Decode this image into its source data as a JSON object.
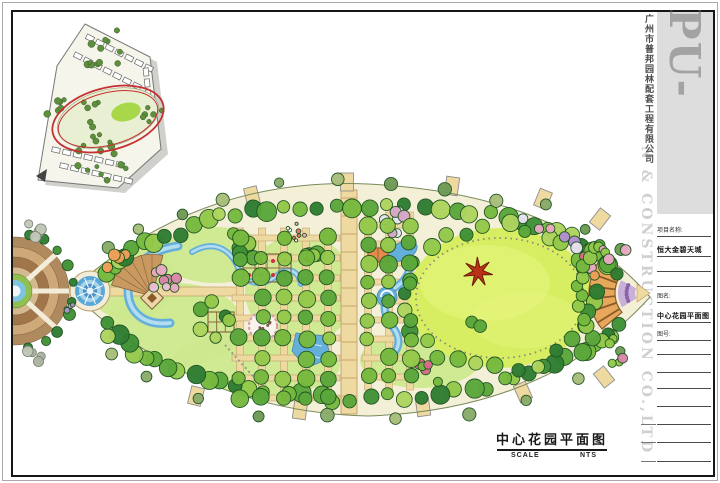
{
  "caption": {
    "title": "中心花园平面图",
    "scale_label": "SCALE",
    "scale_value": "NTS"
  },
  "watermark": {
    "brand": "PU-BANG",
    "company_cn": "广州市普邦园林配套工程有限公司",
    "company_en": "N & CONSTRUCTION CO.,LTD"
  },
  "title_block": {
    "rows": [
      {
        "type": "label",
        "text": "项目名称:"
      },
      {
        "type": "value",
        "text": "恒大金碧天城"
      },
      {
        "type": "blank",
        "text": ""
      },
      {
        "type": "blank",
        "text": ""
      },
      {
        "type": "label",
        "text": "图名:"
      },
      {
        "type": "value",
        "text": "中心花园平面图"
      },
      {
        "type": "label",
        "text": "图号:"
      },
      {
        "type": "blank",
        "text": ""
      },
      {
        "type": "blank",
        "text": ""
      },
      {
        "type": "blank",
        "text": ""
      },
      {
        "type": "blank",
        "text": ""
      },
      {
        "type": "blank",
        "text": ""
      },
      {
        "type": "blank",
        "text": ""
      },
      {
        "type": "blank",
        "text": ""
      }
    ]
  },
  "palette": {
    "leaf_base": "#f4f0d8",
    "leaf_edge": "#7a8a5a",
    "lawn_light": "#cde88f",
    "lawn_bright": "#d8ee62",
    "lawn_streak": "#e6f57e",
    "path_tan": "#eed9a0",
    "path_edge": "#bb9660",
    "water": "#64b0da",
    "water_light": "#b2dcef",
    "water_edge": "#4a88b0",
    "plaza_brown1": "#b08a5f",
    "plaza_brown2": "#cfa87a",
    "plaza_brown3": "#a0754a",
    "plaza_brown4": "#d4b88f",
    "walkway_cream": "#f2ecd8",
    "pergola_orange": "#e8a85c",
    "pergola_edge": "#8a5a2a",
    "flower_purple": "#c3a8d8",
    "sculpture_red": "#b83315",
    "tree_greens": [
      "#2e7d32",
      "#3f9136",
      "#5aa73a",
      "#76b93e",
      "#93c94a",
      "#aed45e"
    ],
    "tree_accents": [
      "#eba9c4",
      "#f0a058",
      "#d86a8a",
      "#e8e4f2",
      "#b490d0"
    ],
    "tree_stroke": "#1e5220",
    "inset_green": "#5d8f3c",
    "red_highlight": "#c53030"
  },
  "plan": {
    "outline": "M70,291 Q198,176 368,184 Q562,194 650,297 Q548,410 368,416 Q196,412 70,291 Z",
    "connector": [
      60,
      286,
      40,
      10
    ],
    "axis_path": [
      94,
      287,
      148,
      9
    ],
    "central_road": {
      "x": 341,
      "y": 190,
      "w": 16,
      "h": 224
    },
    "grids": [
      {
        "xs": [
          240,
          262,
          284,
          306,
          328
        ],
        "ys": [
          238,
          258,
          278,
          298,
          318,
          338,
          358,
          378,
          398
        ],
        "vy": [
          228,
          400
        ],
        "hx": [
          232,
          340
        ],
        "seed": 101
      },
      {
        "xs": [
          368,
          389,
          410
        ],
        "ys": [
          225,
          244,
          263,
          282,
          301,
          320,
          339,
          358,
          377
        ],
        "vy": [
          212,
          390
        ],
        "hx": [
          362,
          408
        ],
        "seed": 102
      }
    ],
    "lawn": {
      "cx": 500,
      "cy": 298,
      "rx": 92,
      "ry": 70
    },
    "lawn_ring": {
      "rx": 84,
      "ry": 60
    },
    "patches": [
      {
        "cx": 175,
        "cy": 325,
        "rx": 68,
        "ry": 42
      },
      {
        "cx": 255,
        "cy": 365,
        "rx": 85,
        "ry": 32
      },
      {
        "cx": 300,
        "cy": 290,
        "rx": 55,
        "ry": 55
      },
      {
        "cx": 215,
        "cy": 255,
        "rx": 55,
        "ry": 28
      },
      {
        "cx": 130,
        "cy": 280,
        "rx": 45,
        "ry": 40
      },
      {
        "cx": 420,
        "cy": 360,
        "rx": 60,
        "ry": 28
      }
    ],
    "water": {
      "crescent": "M178,246 C150,250 130,266 128,290 C128,312 144,326 170,323",
      "meander": "M192,252 C216,238 232,252 238,268 C244,284 262,288 276,276 C288,266 298,270 301,284",
      "stream": "M401,247 C415,259 411,277 396,287 C382,297 381,312 392,326 C402,338 400,350 389,357",
      "pond2": {
        "cx": 403,
        "cy": 251,
        "rx": 15,
        "ry": 9,
        "rot": -25
      },
      "swirl": {
        "cx": 387,
        "cy": 297,
        "r": 10
      },
      "pond3": "296,333 325,336 331,358 306,368 292,351"
    },
    "pool": {
      "cx": 90,
      "cy": 291
    },
    "plaza": {
      "cx": 15,
      "cy": 291
    },
    "fan": {
      "apex": [
        152,
        296
      ],
      "r": 42,
      "a0": 195,
      "a1": 285
    },
    "pavilion": {
      "cx": 152,
      "cy": 298
    },
    "mound": {
      "cx": 263,
      "cy": 326,
      "r": 14
    },
    "pergola_sq": [
      {
        "x": 243,
        "y": 254,
        "w": 48,
        "h": 28,
        "cols": 4,
        "rows": 2,
        "dots": true,
        "fill": "none"
      },
      {
        "x": 208,
        "y": 312,
        "w": 26,
        "h": 20,
        "cols": 3,
        "rows": 2,
        "dots": false,
        "fill": "none"
      },
      {
        "x": 368,
        "y": 248,
        "w": 20,
        "h": 14,
        "cols": 2,
        "rows": 1,
        "dots": false,
        "fill": "#e8894a"
      }
    ],
    "arc": {
      "cx": 645,
      "cy": 293,
      "r1": 30,
      "r2": 56,
      "a0": 140,
      "a1": 220
    },
    "purple_band": {
      "r1": 10,
      "r2": 27,
      "a0": 148,
      "a1": 212
    },
    "tip": "637,284 650,293 637,302",
    "sculpture": {
      "cx": 478,
      "cy": 272,
      "spikes": 7,
      "r1": 15,
      "r2": 5
    },
    "stone_path": [
      225,
      345,
      268,
      393
    ],
    "stubs": [
      [
        347,
        182,
        0
      ],
      [
        452,
        186,
        8
      ],
      [
        543,
        199,
        22
      ],
      [
        252,
        196,
        -14
      ],
      [
        300,
        410,
        8
      ],
      [
        423,
        407,
        -8
      ],
      [
        523,
        392,
        -24
      ],
      [
        196,
        396,
        14
      ],
      [
        600,
        219,
        38
      ],
      [
        604,
        377,
        -38
      ]
    ],
    "belts": [
      {
        "cx": 362,
        "cy": 300,
        "rx": 266,
        "ry": 96,
        "a0": 196,
        "a1": 344,
        "n": 40,
        "rmin": 6,
        "rmax": 10,
        "colors": "greens",
        "jit": 5,
        "seed": 11
      },
      {
        "cx": 362,
        "cy": 300,
        "rx": 266,
        "ry": 98,
        "a0": 16,
        "a1": 164,
        "n": 40,
        "rmin": 6,
        "rmax": 10,
        "colors": "greens",
        "jit": 5,
        "seed": 22
      },
      {
        "cx": 362,
        "cy": 300,
        "rx": 288,
        "ry": 118,
        "a0": 208,
        "a1": 332,
        "n": 12,
        "rmin": 4.5,
        "rmax": 7,
        "colors": [
          "#8aab6a",
          "#a8bd7a",
          "#6d9a54"
        ],
        "jit": 6,
        "seed": 33
      },
      {
        "cx": 362,
        "cy": 300,
        "rx": 288,
        "ry": 118,
        "a0": 28,
        "a1": 152,
        "n": 10,
        "rmin": 4.5,
        "rmax": 7,
        "colors": [
          "#8aab6a",
          "#a8bd7a",
          "#6d9a54"
        ],
        "jit": 6,
        "seed": 44
      },
      {
        "cx": 500,
        "cy": 298,
        "rx": 95,
        "ry": 72,
        "a0": 0,
        "a1": 352,
        "n": 28,
        "rmin": 6,
        "rmax": 9,
        "colors": "greens",
        "jit": 5,
        "seed": 55
      },
      {
        "cx": 500,
        "cy": 298,
        "rx": 100,
        "ry": 78,
        "a0": 285,
        "a1": 345,
        "n": 9,
        "rmin": 4.5,
        "rmax": 6.5,
        "colors": "accents",
        "jit": 4,
        "seed": 66
      },
      {
        "cx": 645,
        "cy": 293,
        "rx": 66,
        "ry": 66,
        "a0": 130,
        "a1": 230,
        "n": 12,
        "rmin": 5,
        "rmax": 8,
        "colors": [
          "#76b93e",
          "#93c94a",
          "#5aa73a"
        ],
        "jit": 3,
        "seed": 77
      },
      {
        "cx": 16,
        "cy": 291,
        "rx": 58,
        "ry": 58,
        "a0": -78,
        "a1": 78,
        "n": 10,
        "rmin": 4,
        "rmax": 6,
        "colors": [
          "#2e7d32",
          "#3f9136"
        ],
        "jit": 2,
        "seed": 88
      }
    ],
    "clusters": [
      {
        "cx": 168,
        "cy": 280,
        "s": 16,
        "n": 8,
        "rmin": 4,
        "rmax": 6,
        "colors": [
          "#eba9c4",
          "#e8bfd4",
          "#d886aa"
        ],
        "seed": 1
      },
      {
        "cx": 118,
        "cy": 262,
        "s": 13,
        "n": 5,
        "rmin": 4,
        "rmax": 6,
        "colors": [
          "#f0a058",
          "#eec084"
        ],
        "seed": 2
      },
      {
        "cx": 398,
        "cy": 222,
        "s": 15,
        "n": 7,
        "rmin": 4,
        "rmax": 6,
        "colors": [
          "#e8e4f2",
          "#b490d0",
          "#d8a8c8"
        ],
        "seed": 3
      },
      {
        "cx": 214,
        "cy": 322,
        "s": 22,
        "n": 6,
        "rmin": 5.5,
        "rmax": 8,
        "colors": "greens",
        "seed": 4
      },
      {
        "cx": 240,
        "cy": 250,
        "s": 20,
        "n": 6,
        "rmin": 5.5,
        "rmax": 8,
        "colors": "greens",
        "seed": 5
      },
      {
        "cx": 310,
        "cy": 255,
        "s": 16,
        "n": 4,
        "rmin": 5.5,
        "rmax": 8,
        "colors": "greens",
        "seed": 6
      },
      {
        "cx": 296,
        "cy": 231,
        "s": 10,
        "n": 8,
        "rmin": 1.4,
        "rmax": 2.4,
        "colors": [
          "#ffffff",
          "#eba9c4",
          "#e86a70"
        ],
        "seed": 7
      },
      {
        "cx": 430,
        "cy": 370,
        "s": 18,
        "n": 5,
        "rmin": 4,
        "rmax": 6,
        "colors": [
          "#d86a8a",
          "#b63a4a",
          "#76b93e"
        ],
        "seed": 8
      },
      {
        "cx": 615,
        "cy": 350,
        "s": 14,
        "n": 5,
        "rmin": 3.5,
        "rmax": 5.5,
        "colors": [
          "#eba9c4",
          "#d886aa",
          "#93c94a"
        ],
        "seed": 9
      },
      {
        "cx": 612,
        "cy": 247,
        "s": 14,
        "n": 5,
        "rmin": 3.5,
        "rmax": 5.5,
        "colors": [
          "#eba9c4",
          "#93c94a"
        ],
        "seed": 10
      },
      {
        "cx": 40,
        "cy": 228,
        "s": 14,
        "n": 4,
        "rmin": 4,
        "rmax": 6,
        "colors": [
          "#aab4a0",
          "#c2c8b8"
        ],
        "stroke": "#7a8474",
        "seed": 12
      },
      {
        "cx": 40,
        "cy": 356,
        "s": 14,
        "n": 4,
        "rmin": 4,
        "rmax": 6,
        "colors": [
          "#aab4a0",
          "#c2c8b8"
        ],
        "stroke": "#7a8474",
        "seed": 13
      },
      {
        "cx": 66,
        "cy": 304,
        "s": 8,
        "n": 4,
        "rmin": 2,
        "rmax": 3,
        "colors": [
          "#b490d0",
          "#8a6ab8"
        ],
        "seed": 15
      },
      {
        "cx": 478,
        "cy": 320,
        "s": 10,
        "n": 2,
        "rmin": 5,
        "rmax": 7,
        "colors": [
          "#5aa73a"
        ],
        "seed": 14
      }
    ],
    "inset": {
      "poly": "85,24 150,57 161,149 118,188 38,180 57,66",
      "shadow_dx": 7,
      "shadow_dy": 5,
      "rows": [
        [
          90,
          38,
          27,
          7
        ],
        [
          78,
          56,
          27,
          7
        ],
        [
          56,
          150,
          13,
          7
        ],
        [
          64,
          166,
          13,
          7
        ],
        [
          146,
          72,
          84,
          5
        ]
      ],
      "oval": {
        "cx": 108,
        "cy": 118,
        "rx": 52,
        "ry": 28,
        "rot": -15
      },
      "red1": {
        "cx": 108,
        "cy": 119,
        "rx": 57,
        "ry": 31,
        "rot": -15
      },
      "red2": {
        "cx": 108,
        "cy": 119,
        "rx": 51,
        "ry": 26,
        "rot": -15
      },
      "blob": {
        "cx": 126,
        "cy": 112,
        "rx": 15,
        "ry": 9,
        "rot": -15
      },
      "arrow": "36,176 47,169 45,182",
      "greens": [
        [
          100,
          50,
          28,
          12
        ],
        [
          95,
          165,
          33,
          12
        ],
        [
          58,
          110,
          12,
          6
        ],
        [
          152,
          115,
          12,
          6
        ],
        [
          108,
          118,
          30,
          10
        ]
      ]
    }
  }
}
